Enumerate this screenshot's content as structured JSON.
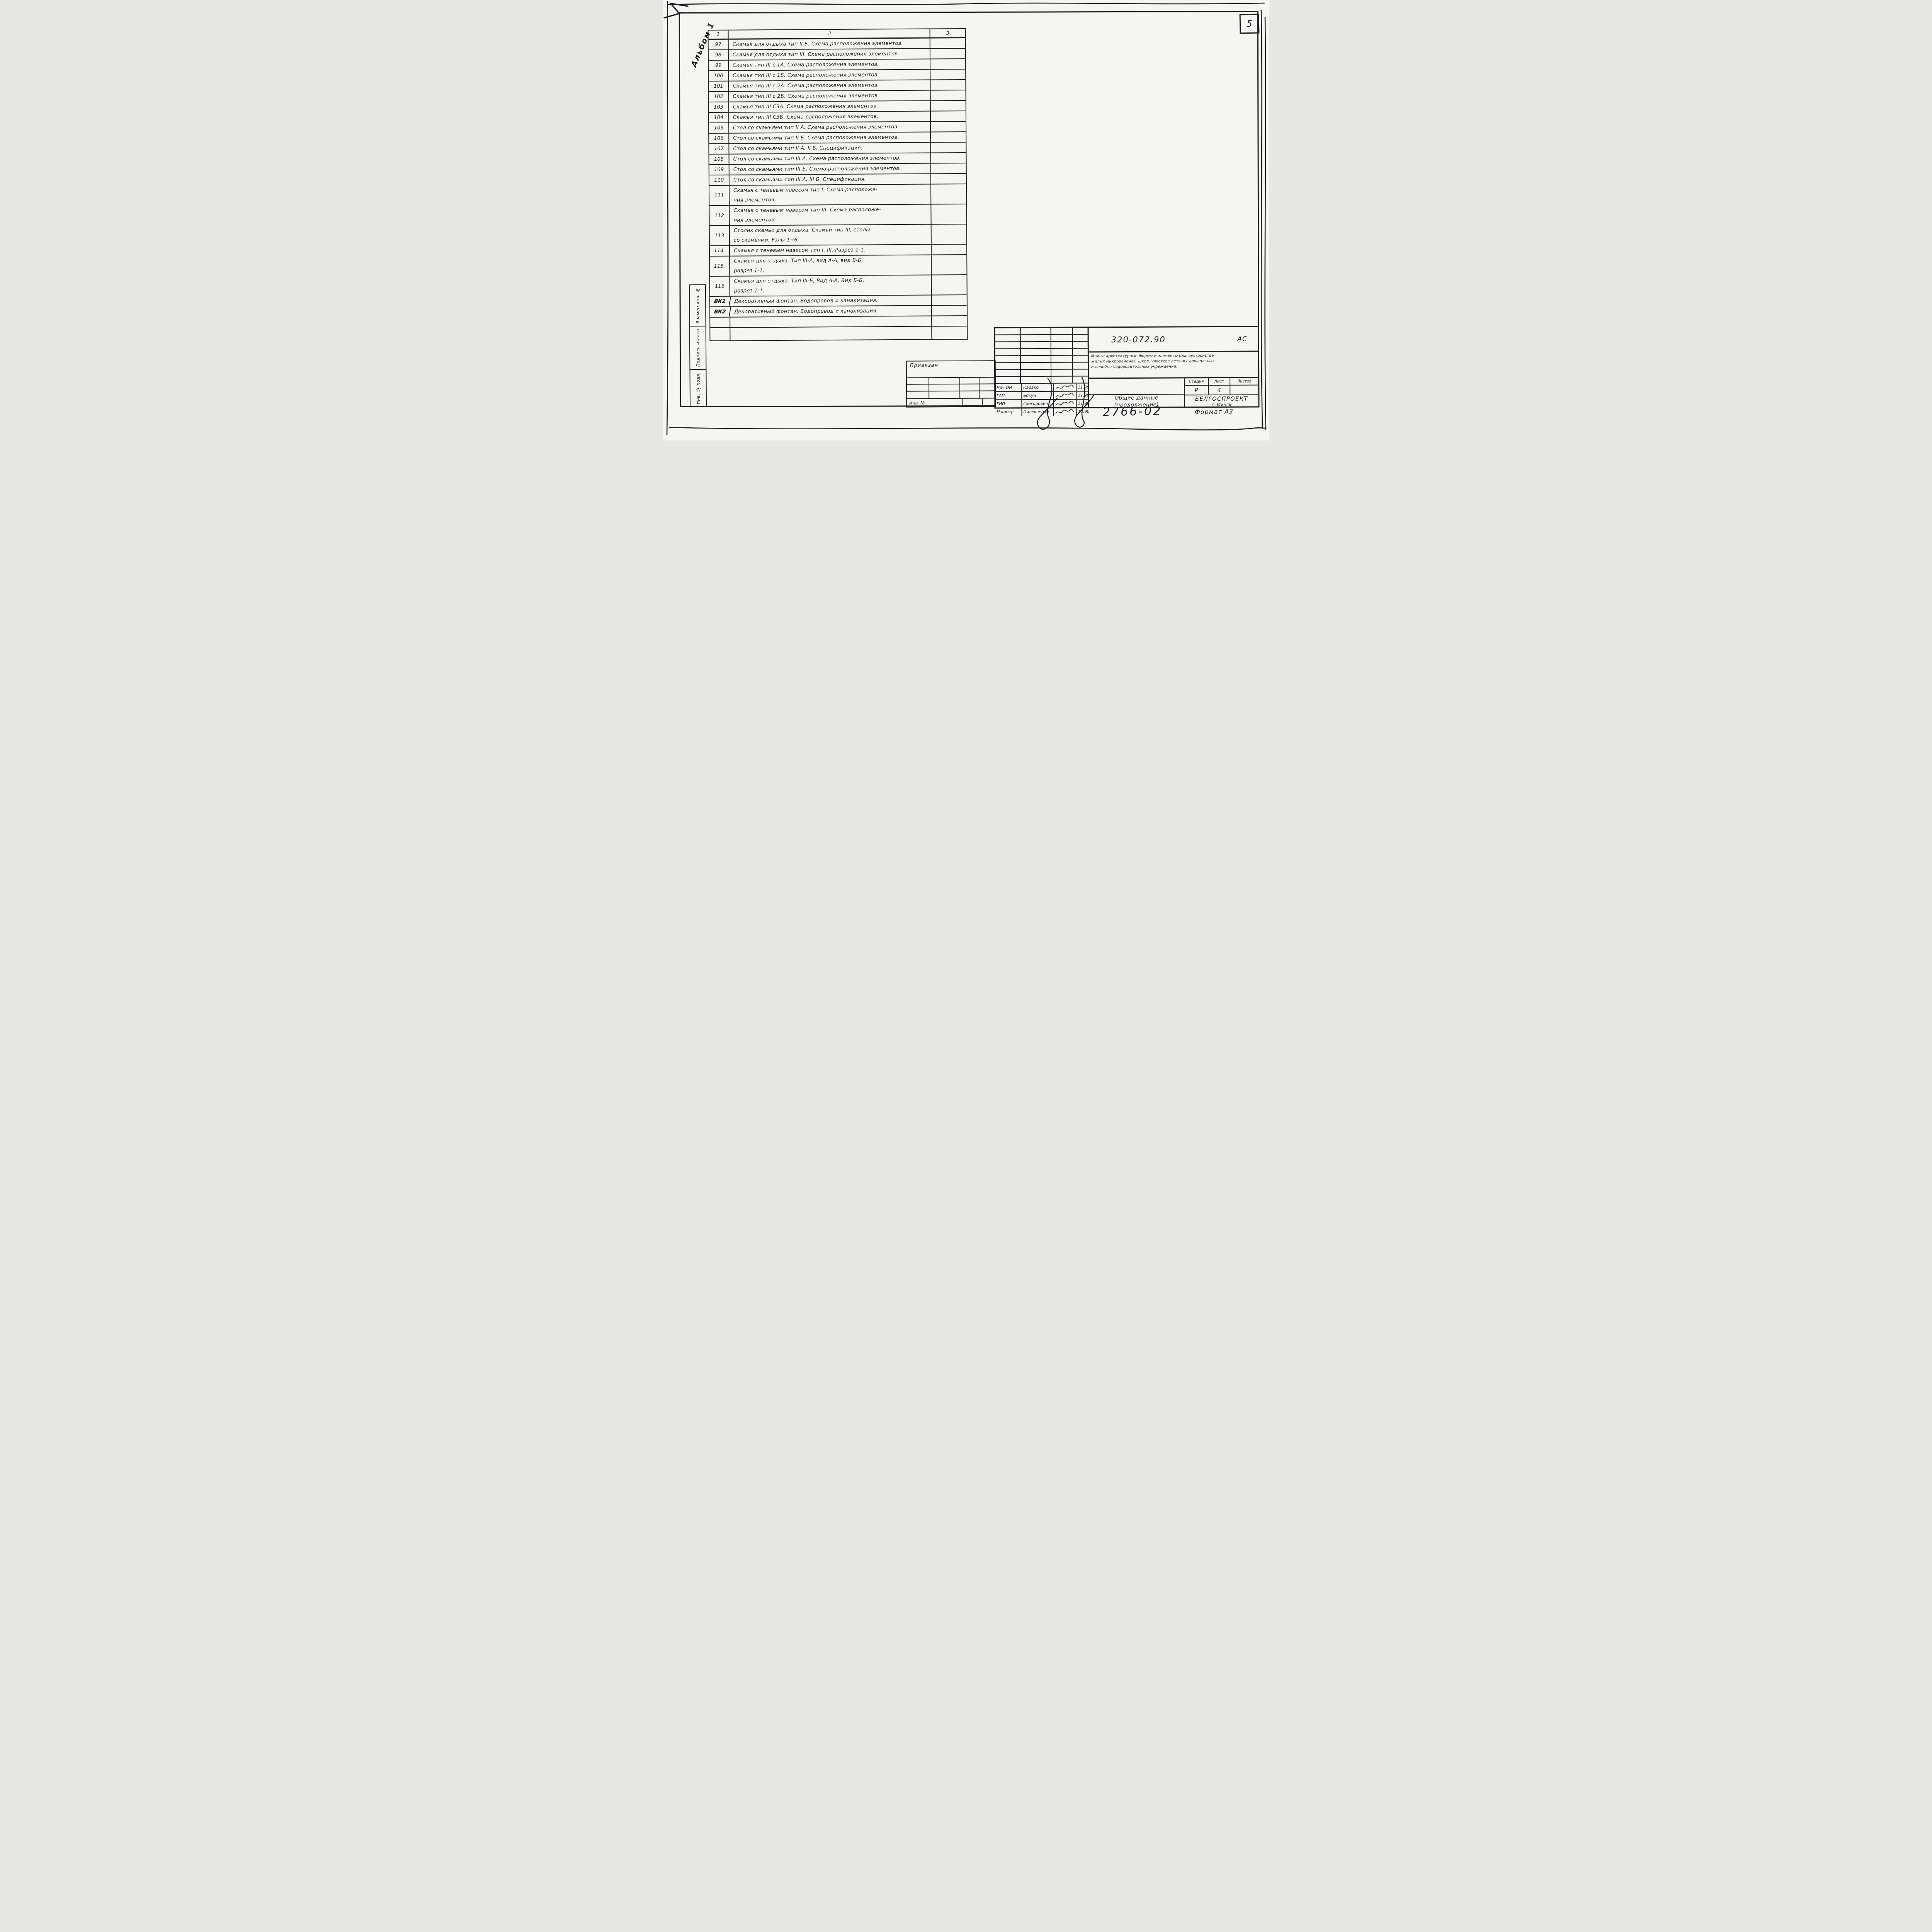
{
  "colors": {
    "ink": "#1b1b1b",
    "paper": "#f6f5f1"
  },
  "sheet": {
    "page_number": "5",
    "album_label": "Альбом 1",
    "order_number": "2766-02",
    "format_label": "Формат А3"
  },
  "table": {
    "header": {
      "col1": "1",
      "col2": "2",
      "col3": "3"
    },
    "rows": [
      {
        "num": "97",
        "text": "Скамья для отдыха тип II Б. Схема расположения элементов."
      },
      {
        "num": "98",
        "text": "Скамья для отдыха тип III. Схема расположения элементов."
      },
      {
        "num": "99",
        "text": "Скамья тип III с 1А. Схема расположения элементов."
      },
      {
        "num": "100",
        "text": "Скамья тип III с 1Б. Схема расположения элементов."
      },
      {
        "num": "101",
        "text": "Скамья тип III с 2А. Схема расположения элементов."
      },
      {
        "num": "102",
        "text": "Скамья тип III с 2Б. Схема расположения элементов."
      },
      {
        "num": "103",
        "text": "Скамья тип III С3А. Схема расположения элементов."
      },
      {
        "num": "104",
        "text": "Скамья тип III С3Б. Схема расположения элементов."
      },
      {
        "num": "105",
        "text": "Стол со скамьями тип II А. Схема расположения элементов."
      },
      {
        "num": "106",
        "text": "Стол со скамьями тип II Б. Схема расположения элементов."
      },
      {
        "num": "107",
        "text": "Стол со скамьями тип II А, II Б. Спецификация."
      },
      {
        "num": "108",
        "text": "Стол со скамьями тип III А. Схема расположения элементов."
      },
      {
        "num": "109",
        "text": "Стол со скамьями тип III Б. Схема расположения элементов."
      },
      {
        "num": "110",
        "text": "Стол со скамьями тип III А, III Б. Спецификация."
      },
      {
        "num": "111",
        "text": "Скамья с теневым навесом тип I. Схема расположе-\nния элементов."
      },
      {
        "num": "112",
        "text": "Скамья с теневым навесом тип III. Схема расположе-\nния элементов."
      },
      {
        "num": "113",
        "text": "Столик скамьи для отдыха, Скамьи тип III, столы\nсо скамьями. Узлы 1÷6."
      },
      {
        "num": "114.",
        "text": "Скамья с теневым навесом тип I, III. Разрез 1-1."
      },
      {
        "num": "115.",
        "text": "Скамья для отдыха, Тип III-А, вид А-А, вид Б-Б,\nразрез 1-1."
      },
      {
        "num": "116",
        "text": "Скамья для отдыха. Тип III-Б, Вид А-А, Вид Б-Б,\nразрез 1-1."
      },
      {
        "num": "ВК1",
        "text": "Декоративный фонтан. Водопровод и канализация."
      },
      {
        "num": "ВК2",
        "text": "Декоративный фонтан. Водопровод и канализация."
      },
      {
        "num": "",
        "text": ""
      },
      {
        "num": "",
        "text": ""
      }
    ]
  },
  "side_strip": {
    "labels": [
      "Взамен инв. №",
      "Подпись и дата",
      "Инв. № подл."
    ]
  },
  "title_block": {
    "code": "320-072.90",
    "mark": "АС",
    "project_title": "Малые архитектурные формы и элементы благоустройства\nжилых микрорайонов, школ, участков детских дошкольных\nи лечебно-оздоровительных учреждений.",
    "stage_label": "Стадия",
    "sheet_label": "Лист",
    "sheets_label": "Листов",
    "stage": "Р",
    "sheet": "4",
    "sheets": "",
    "sheet_title": "Общие данные\n(продолжение)",
    "organization": "БЕЛГОСПРОЕКТ",
    "organization_city": "г. Минск",
    "attached_label": "Привязан",
    "inv_label": "Инв. №",
    "signature_rows": [
      {
        "role": "Нач ОИ",
        "name": "Карако",
        "date": "11.90"
      },
      {
        "role": "ГАП",
        "name": "Бокун",
        "date": "11.90"
      },
      {
        "role": "ГИП",
        "name": "Григорович",
        "date": "11.90"
      },
      {
        "role": "Н.контр.",
        "name": "Пилюшенко",
        "date": "11.90"
      }
    ]
  }
}
